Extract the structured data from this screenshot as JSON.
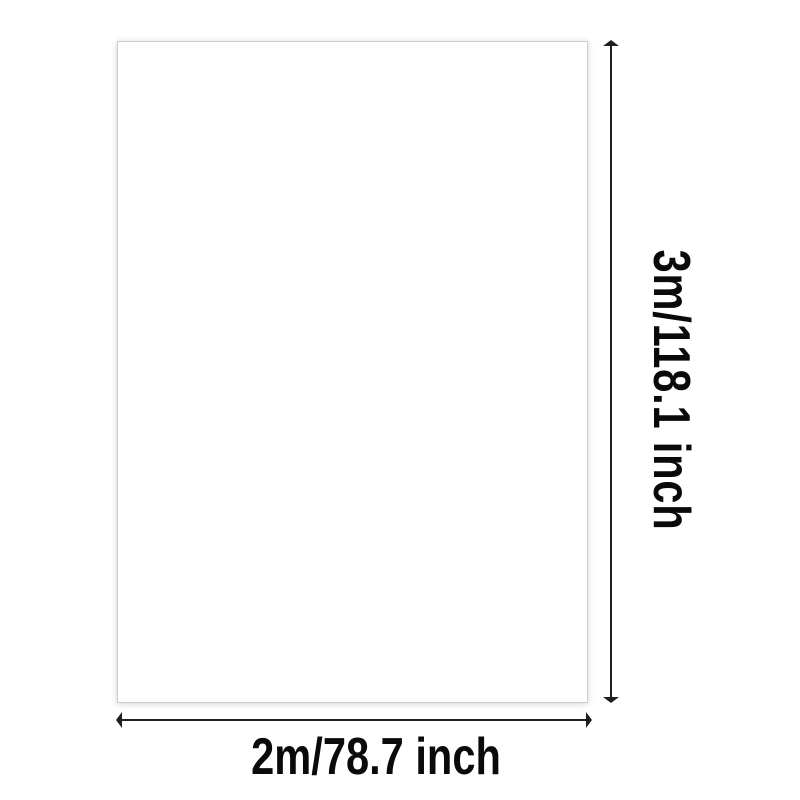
{
  "background_color": "#ffffff",
  "product_panel": {
    "fill_color": "#ffffff",
    "border_color": "#cccccc"
  },
  "height_dimension": {
    "label": "3m/118.1 inch"
  },
  "width_dimension": {
    "label": "2m/78.7 inch"
  },
  "style": {
    "line_color": "#1f1f1f",
    "text_color": "#0a0a0a"
  }
}
